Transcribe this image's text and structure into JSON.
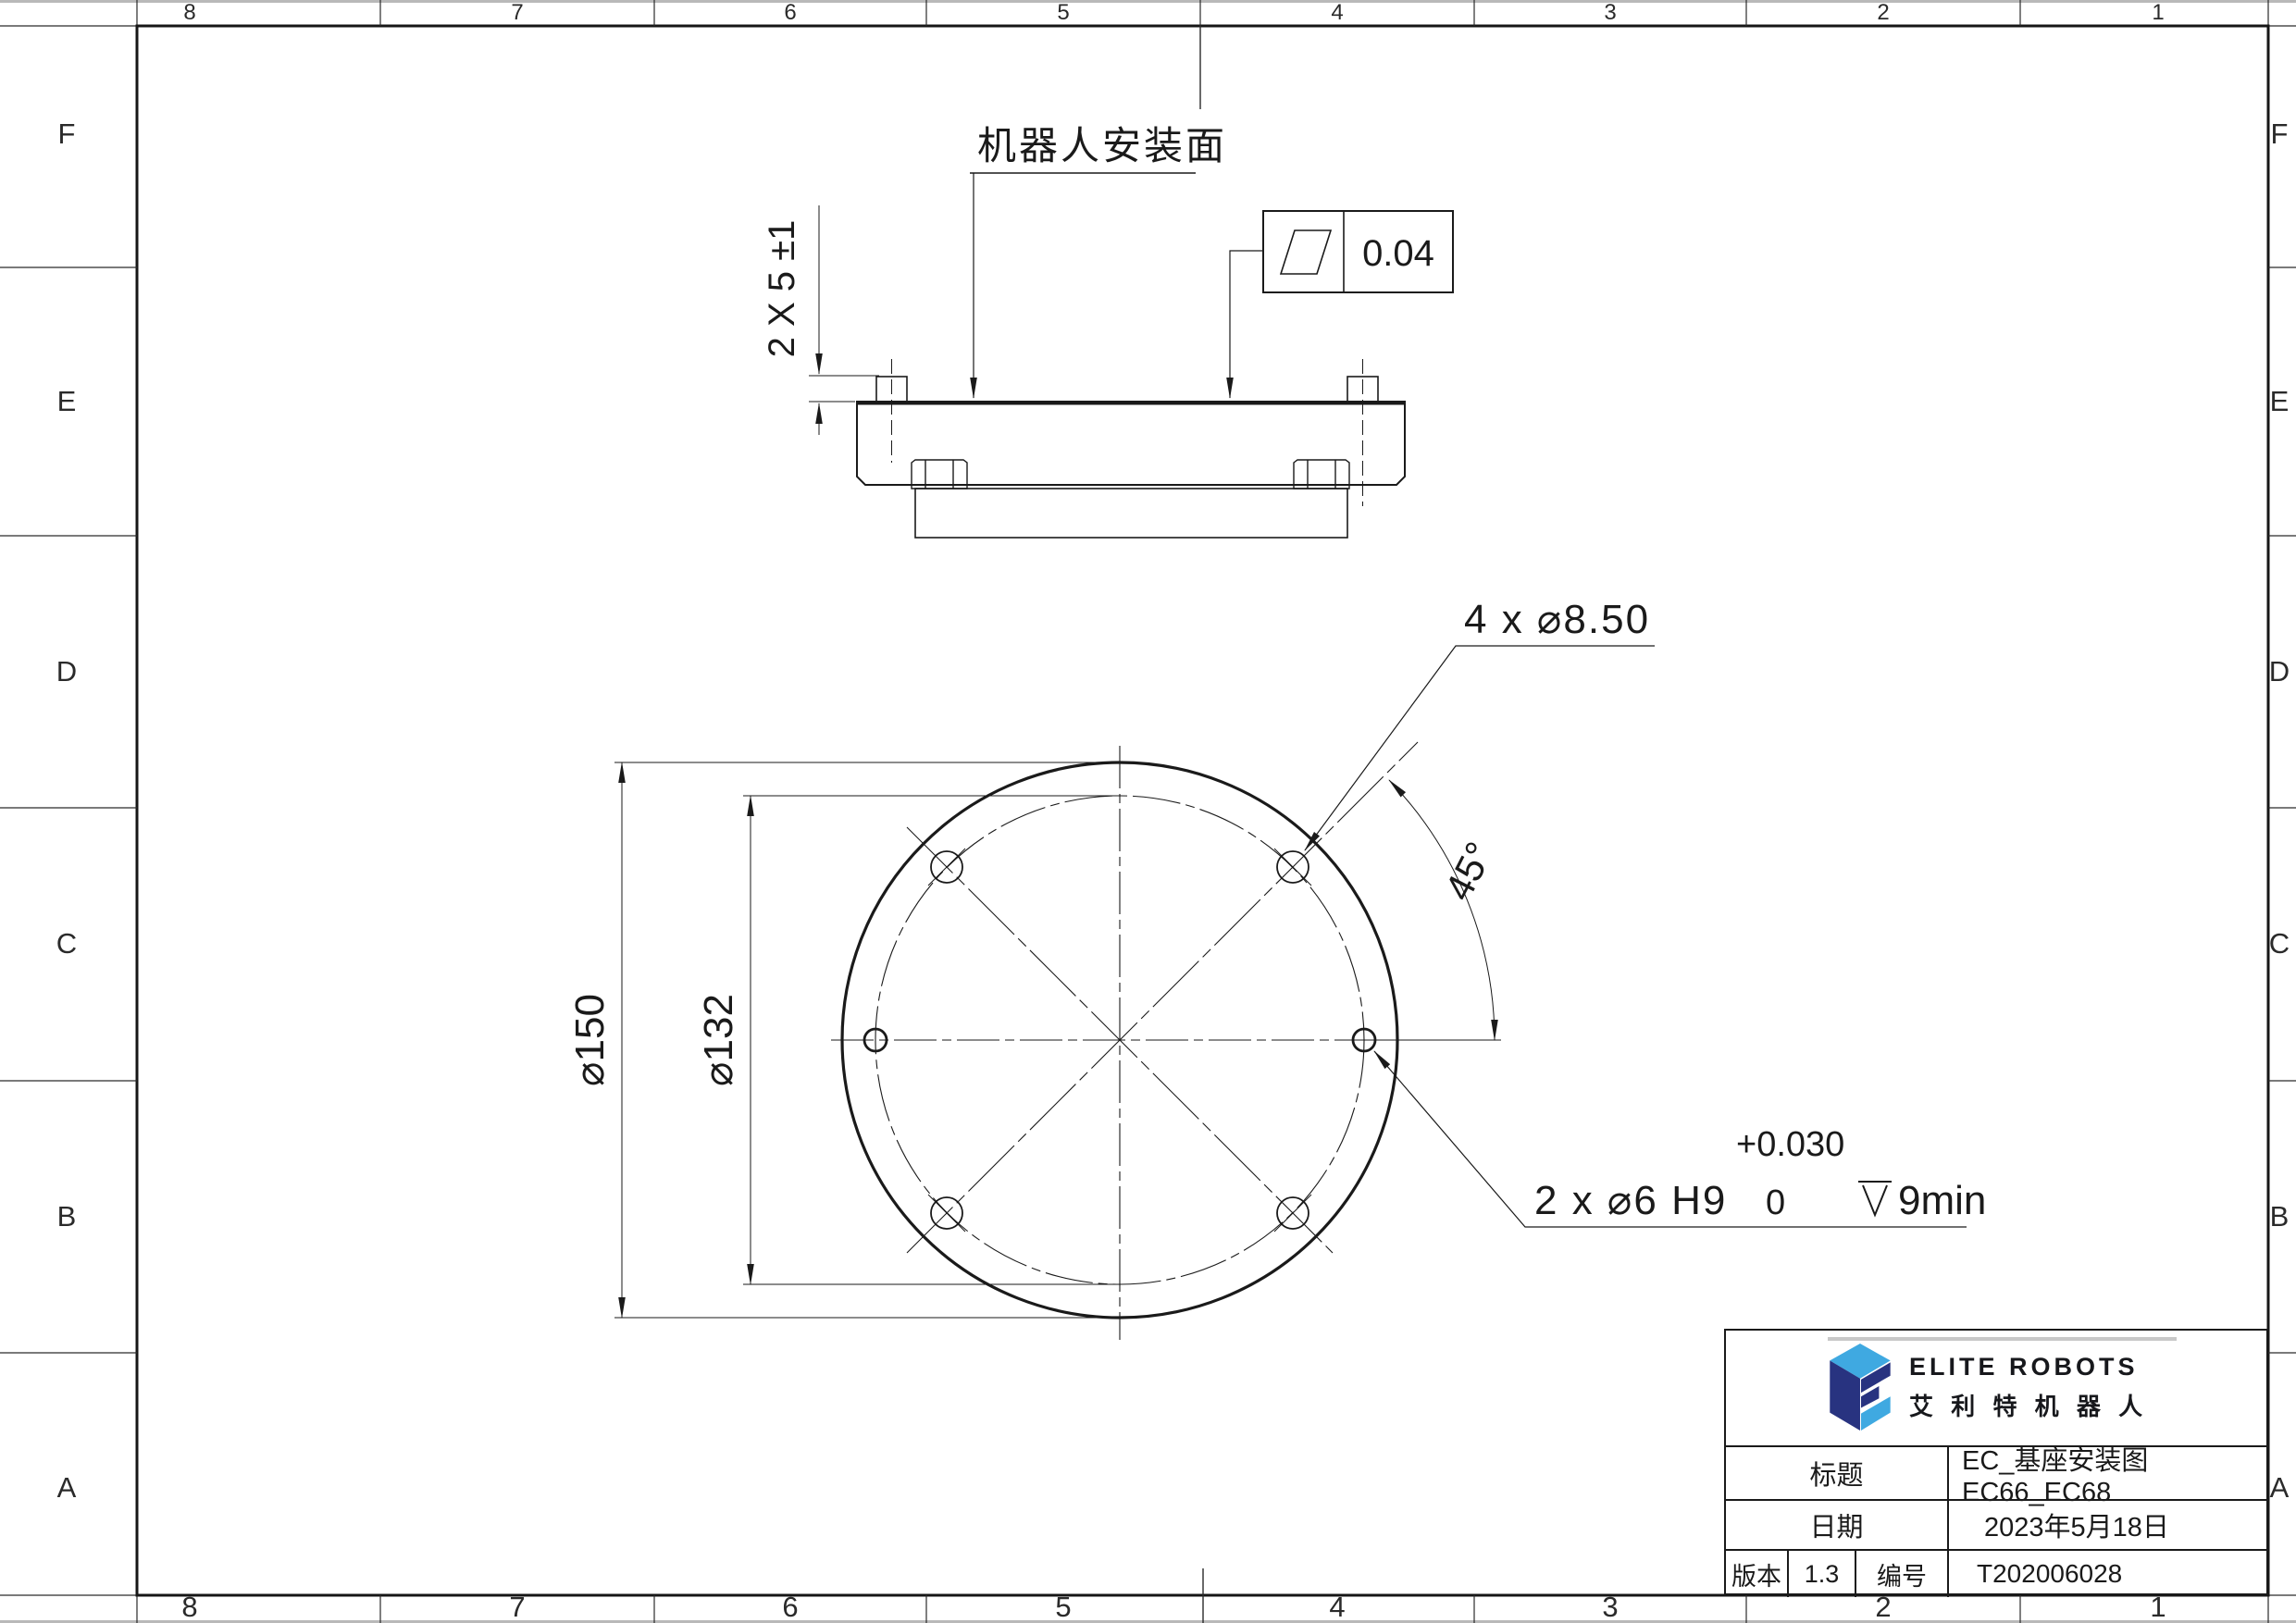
{
  "sheet": {
    "zones_top": [
      "8",
      "7",
      "6",
      "5",
      "4",
      "3",
      "2",
      "1"
    ],
    "zones_bottom": [
      "8",
      "7",
      "6",
      "5",
      "4",
      "3",
      "2",
      "1"
    ],
    "zones_left": [
      "F",
      "E",
      "D",
      "C",
      "B",
      "A"
    ],
    "zones_right": [
      "F",
      "E",
      "D",
      "C",
      "B",
      "A"
    ]
  },
  "side_view": {
    "surface_label": "机器人安装面",
    "pin_height_dim": "2 X 5 ±1",
    "flatness_tolerance": "0.04"
  },
  "plan_view": {
    "outer_dia": "⌀150",
    "bolt_circle_dia": "⌀132",
    "bolt_hole_callout": "4 x ⌀8.50",
    "angle": "45°",
    "pin_hole_callout": "2 x ⌀6 H9",
    "pin_tol_upper": "+0.030",
    "pin_tol_lower": "0",
    "pin_depth": "9min"
  },
  "title_block": {
    "brand_en": "ELITE ROBOTS",
    "brand_cn": "艾 利 特 机 器 人",
    "title_label": "标题",
    "title_value": "EC_基座安装图 EC66_EC68",
    "date_label": "日期",
    "date_value": "2023年5月18日",
    "version_label": "版本",
    "version_value": "1.3",
    "number_label": "编号",
    "number_value": "T202006028"
  },
  "colors": {
    "line": "#1a1a1a",
    "logo_navy": "#283380",
    "logo_blue": "#3fa9e1",
    "accent_gray": "#c8c8c8"
  }
}
